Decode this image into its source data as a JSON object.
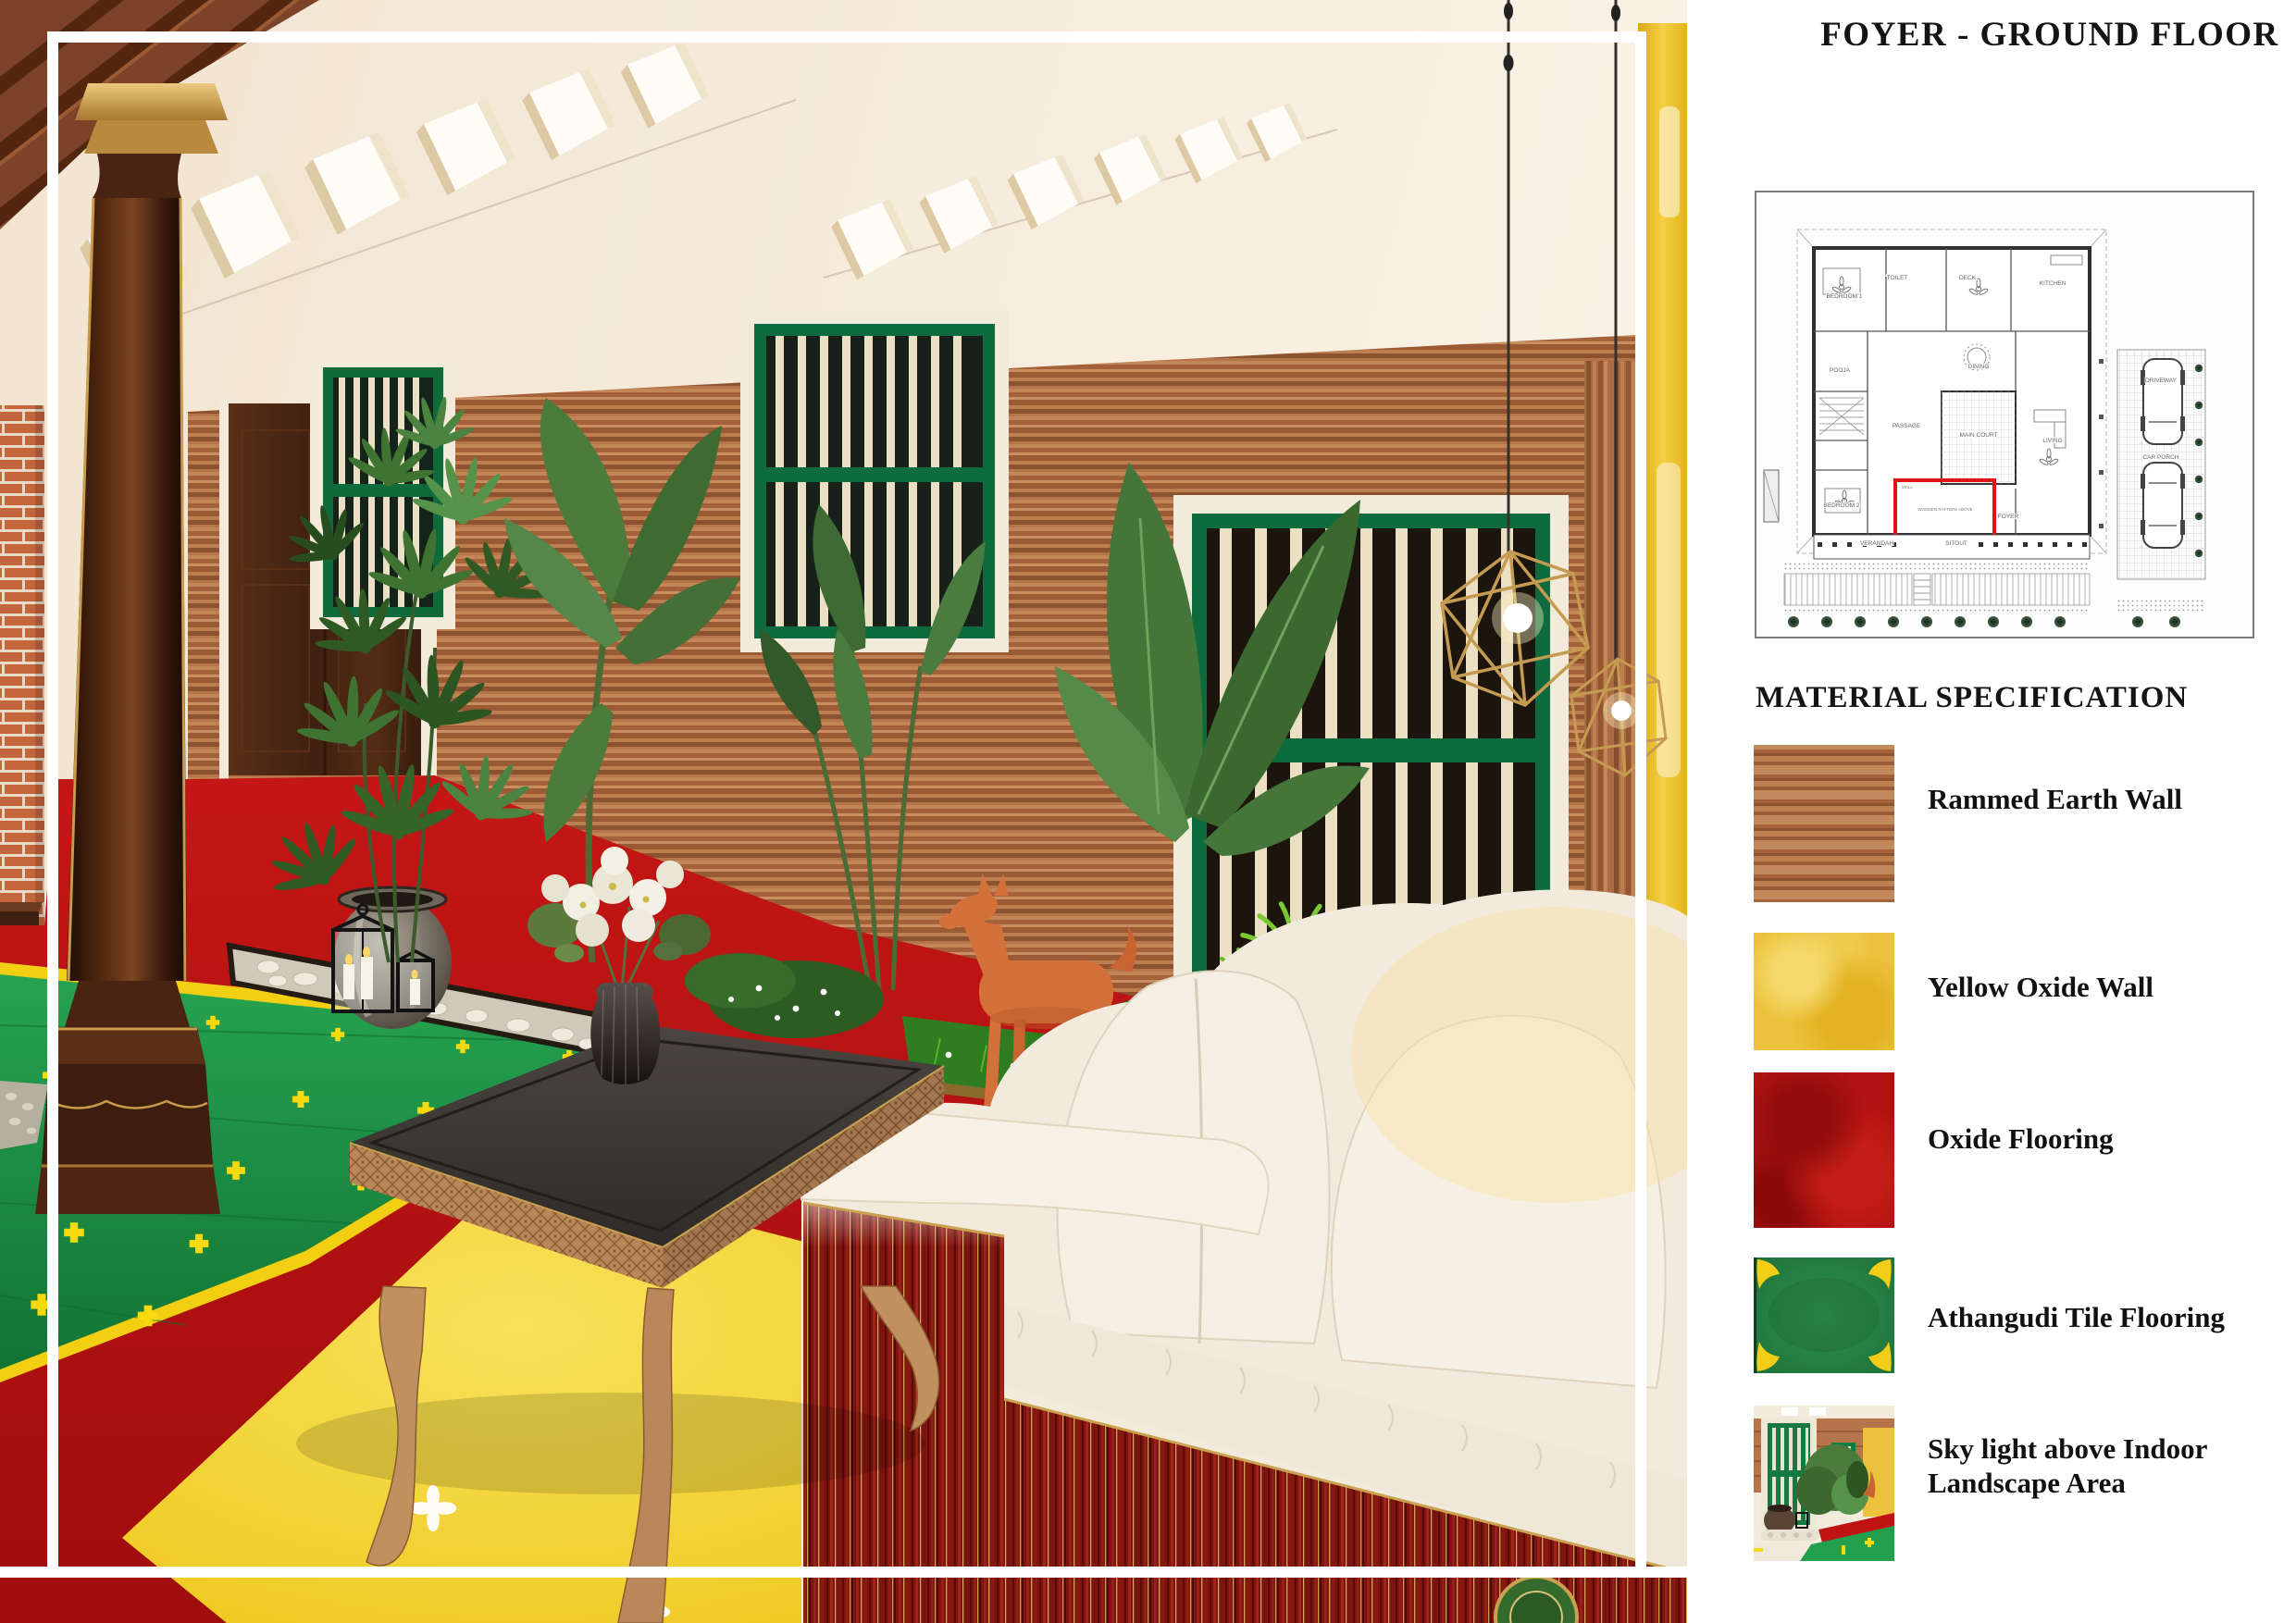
{
  "panel": {
    "title": "FOYER - GROUND FLOOR",
    "section_heading": "MATERIAL SPECIFICATION",
    "materials": [
      {
        "name": "Rammed Earth Wall",
        "swatch": "wood-texture",
        "color": "#a4613a"
      },
      {
        "name": "Yellow Oxide Wall",
        "swatch": "yellow-oxide",
        "color": "#ecc23c"
      },
      {
        "name": "Oxide Flooring",
        "swatch": "red-oxide",
        "color": "#b31212"
      },
      {
        "name": "Athangudi Tile Flooring",
        "swatch": "green-tile",
        "color": "#2c8a4a"
      },
      {
        "name": "Sky light above Indoor Landscape Area",
        "swatch": "skylight-photo",
        "color": "#2c8a4a"
      }
    ]
  },
  "floor_plan": {
    "highlight_color": "#e11414",
    "room_labels": [
      "BEDROOM 1",
      "TOILET",
      "DECK",
      "DINING",
      "KITCHEN",
      "POOJA",
      "PASSAGE",
      "MAIN COURT",
      "LIVING",
      "BEDROOM 2",
      "FOYER",
      "VERANDAH",
      "SITOUT",
      "CAR PORCH",
      "DRIVEWAY",
      "WALL",
      "WOODEN RAFTERS ABOVE"
    ]
  },
  "scene": {
    "key_colors": {
      "rammed_earth_wall": "#b5744a",
      "yellow_oxide_wall": "#eec43e",
      "oxide_floor": "#c01414",
      "athangudi_tile": "#23a04e",
      "window_green": "#0e6b3e",
      "sofa_fabric": "#f4eee2",
      "sofa_wood": "#7c1410",
      "pendant_gold": "#c59b52",
      "horse_terracotta": "#d4713a",
      "ceiling_cream": "#f5ecdd",
      "frame_line": "#ffffff"
    }
  }
}
